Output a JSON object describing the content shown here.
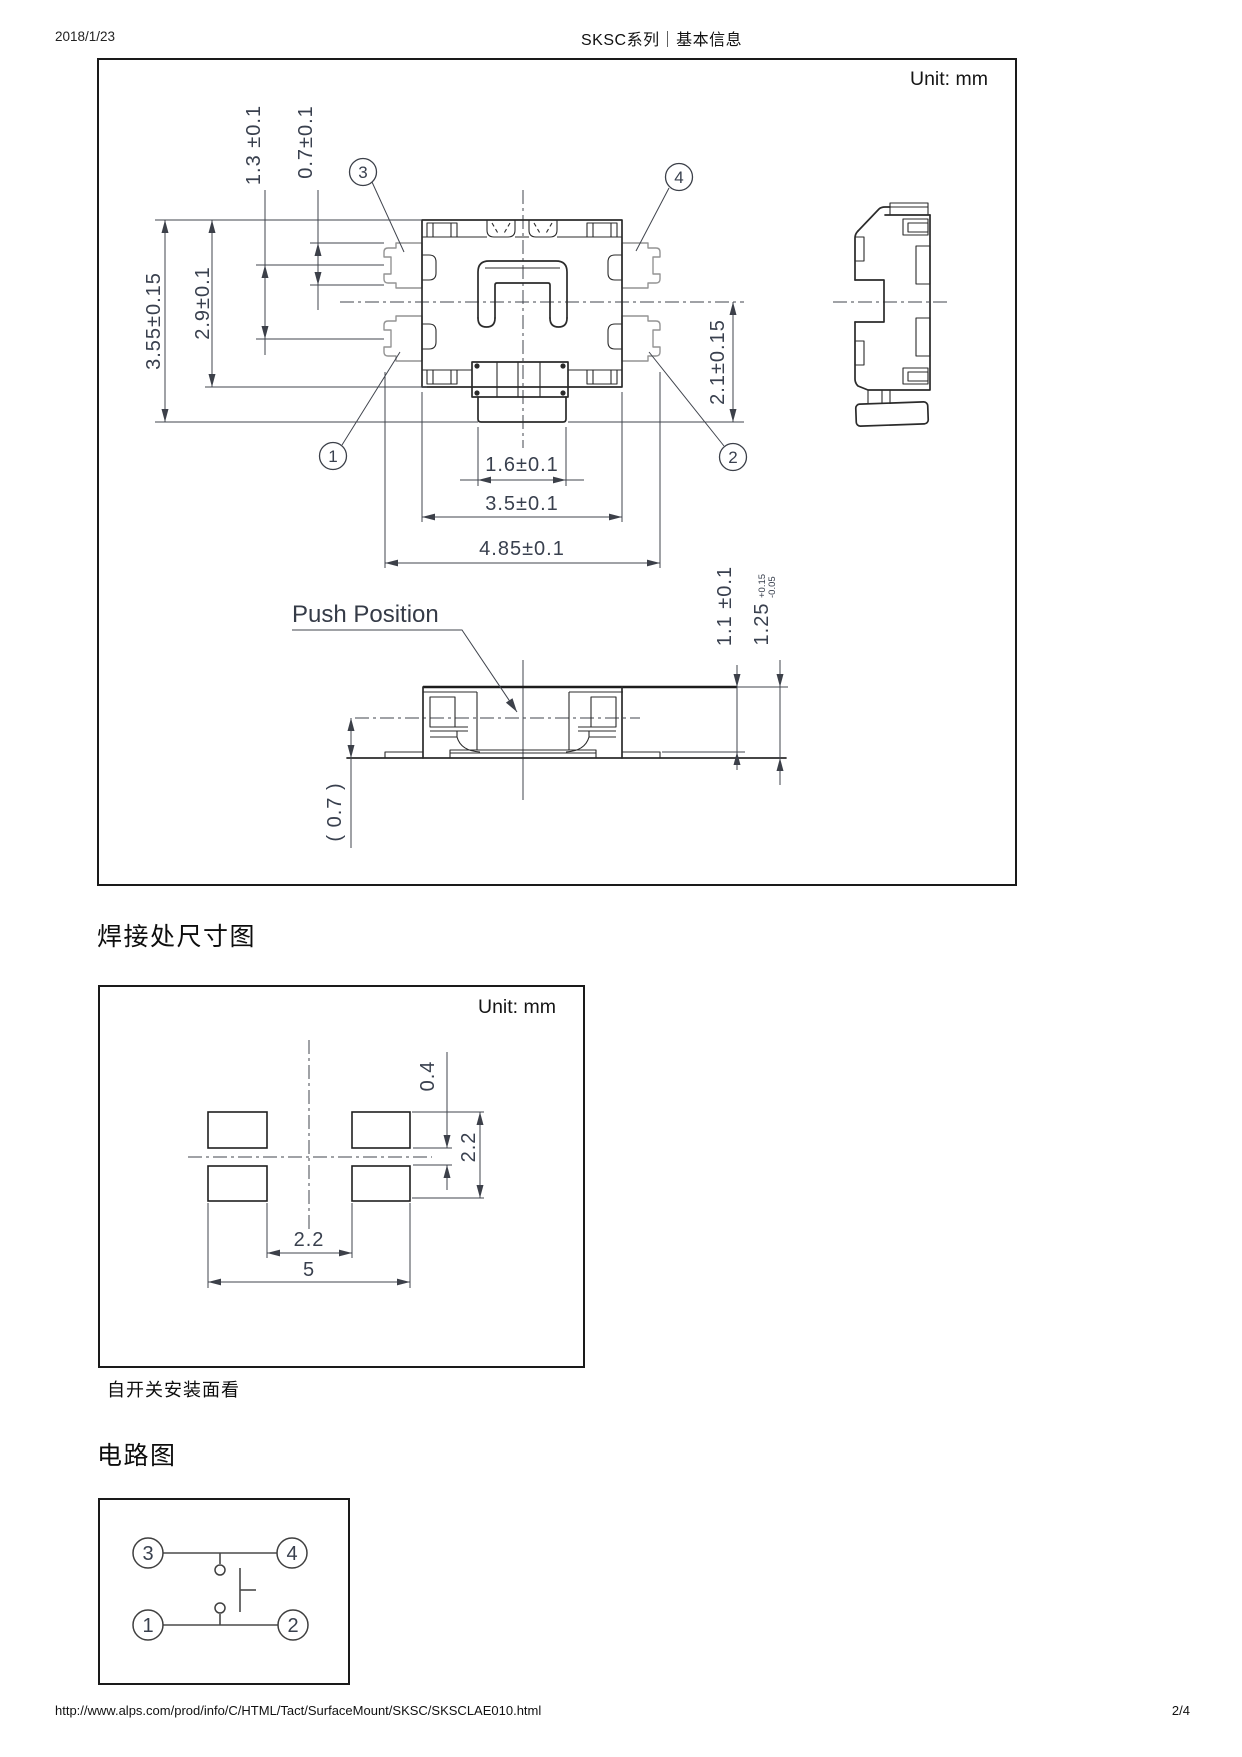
{
  "header": {
    "date": "2018/1/23",
    "title": "SKSC系列｜基本信息"
  },
  "footer": {
    "url": "http://www.alps.com/prod/info/C/HTML/Tact/SurfaceMount/SKSC/SKSCLAE010.html",
    "page": "2/4"
  },
  "colors": {
    "line": "#2b2b2b",
    "dim_text": "#39404e",
    "gray_part": "#949494",
    "border": "#1a1a1a"
  },
  "outline": {
    "unit": "Unit: mm",
    "push_label": "Push Position",
    "dims": {
      "d13": "1.3 ±0.1",
      "d07": "0.7±0.1",
      "d355": "3.55±0.15",
      "d29": "2.9±0.1",
      "d21": "2.1±0.15",
      "d16": "1.6±0.1",
      "d35": "3.5±0.1",
      "d485": "4.85±0.1",
      "d11": "1.1 ±0.1",
      "d125": "1.25",
      "d125p": "+0.15",
      "d125m": "-0.05",
      "d07r": "( 0.7 )"
    },
    "callouts": {
      "c1": "1",
      "c2": "2",
      "c3": "3",
      "c4": "4"
    }
  },
  "land": {
    "heading": "焊接处尺寸图",
    "unit": "Unit: mm",
    "caption": "自开关安装面看",
    "dims": {
      "gap": "0.4",
      "h": "2.2",
      "inner": "2.2",
      "outer": "5"
    }
  },
  "circuit": {
    "heading": "电路图",
    "pins": {
      "p1": "1",
      "p2": "2",
      "p3": "3",
      "p4": "4"
    }
  }
}
